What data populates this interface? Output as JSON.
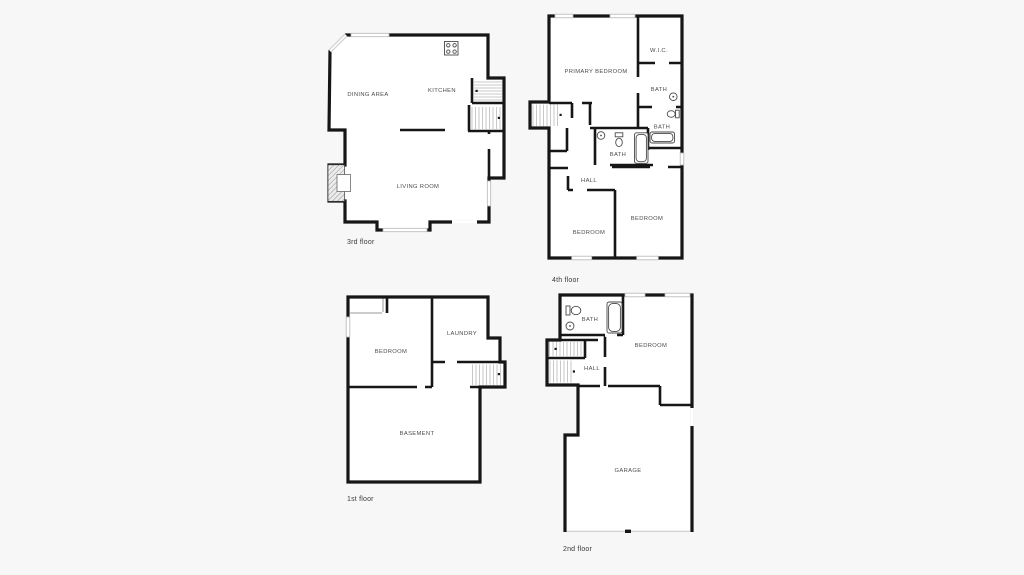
{
  "page": {
    "background_color": "#f7f7f7",
    "wall_color": "#161616",
    "window_color": "#ffffff",
    "room_label_color": "#4c4c4c",
    "floor_label_color": "#3a3a3a"
  },
  "floors": [
    {
      "id": "3rd-floor",
      "label": "3rd floor",
      "rooms": [
        {
          "name": "DINING AREA"
        },
        {
          "name": "KITCHEN"
        },
        {
          "name": "LIVING ROOM"
        }
      ],
      "fixtures": [
        "stove-icon",
        "fireplace-icon",
        "staircase-icon",
        "window-icon"
      ]
    },
    {
      "id": "4th-floor",
      "label": "4th floor",
      "rooms": [
        {
          "name": "PRIMARY BEDROOM"
        },
        {
          "name": "W.I.C."
        },
        {
          "name": "BATH"
        },
        {
          "name": "BATH"
        },
        {
          "name": "BATH"
        },
        {
          "name": "HALL"
        },
        {
          "name": "BEDROOM"
        },
        {
          "name": "BEDROOM"
        }
      ],
      "fixtures": [
        "sink-icon",
        "toilet-icon",
        "bathtub-icon",
        "staircase-icon"
      ]
    },
    {
      "id": "1st-floor",
      "label": "1st floor",
      "rooms": [
        {
          "name": "BEDROOM"
        },
        {
          "name": "LAUNDRY"
        },
        {
          "name": "BASEMENT"
        }
      ],
      "fixtures": [
        "staircase-icon",
        "closet-icon",
        "window-icon"
      ]
    },
    {
      "id": "2nd-floor",
      "label": "2nd floor",
      "rooms": [
        {
          "name": "BATH"
        },
        {
          "name": "HALL"
        },
        {
          "name": "BEDROOM"
        },
        {
          "name": "GARAGE"
        }
      ],
      "fixtures": [
        "toilet-icon",
        "sink-icon",
        "bathtub-icon",
        "staircase-icon",
        "garage-door-icon"
      ]
    }
  ]
}
